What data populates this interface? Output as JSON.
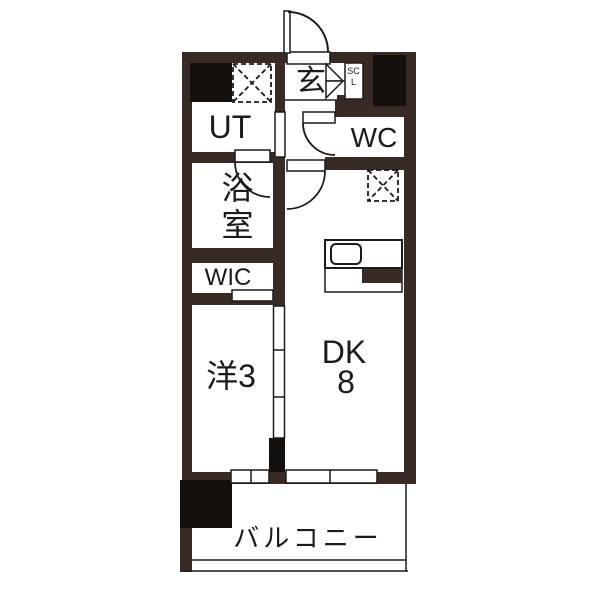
{
  "floorplan": {
    "unit_labels": {
      "entrance": "玄",
      "shoe_closet": "SCL",
      "utility": "UT",
      "toilet": "WC",
      "bathroom": "浴室",
      "walk_in_closet": "WIC",
      "western_room": "洋3",
      "dining_kitchen": "DK",
      "dining_kitchen_size": "8",
      "balcony": "バルコニー"
    },
    "colors": {
      "wall": "#382A24",
      "pillar": "#14100E",
      "line": "#1B1B1B",
      "background": "#FFFFFF"
    },
    "features": [
      "entrance-swing-door",
      "shoe-closet-bifold-door",
      "washing-machine-area-dashed-box",
      "refrigerator-area-dashed-box",
      "kitchen-counter-with-sink",
      "bathroom-swing-door",
      "wc-swing-door",
      "dk-swing-door",
      "three-panel-sliding-door",
      "balcony-windows"
    ]
  }
}
